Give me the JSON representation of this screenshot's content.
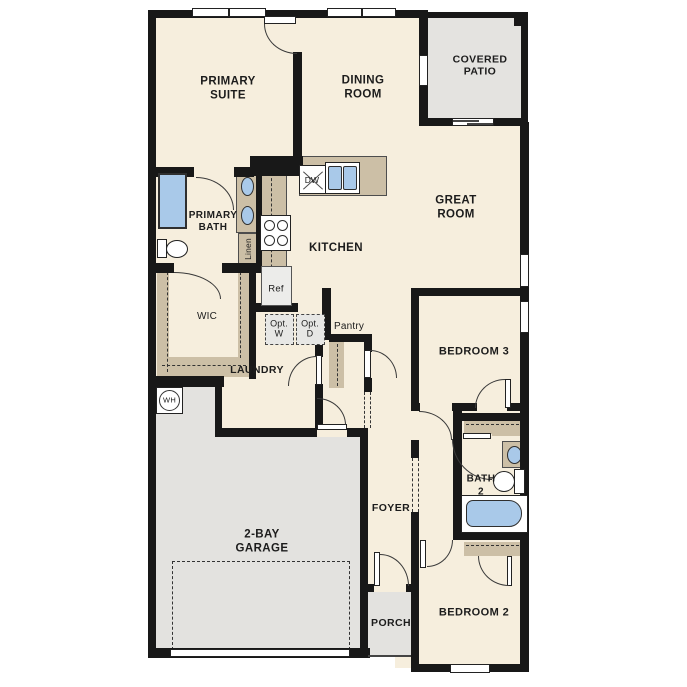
{
  "meta": {
    "type": "residential-floor-plan"
  },
  "rooms": {
    "primary_suite": "PRIMARY\nSUITE",
    "dining_room": "DINING\nROOM",
    "covered_patio": "COVERED\nPATIO",
    "great_room": "GREAT\nROOM",
    "kitchen": "KITCHEN",
    "primary_bath": "PRIMARY\nBATH",
    "wic": "WIC",
    "laundry": "LAUNDRY",
    "pantry": "Pantry",
    "bedroom_3": "BEDROOM 3",
    "bath_2": "BATH\n2",
    "bedroom_2": "BEDROOM 2",
    "foyer": "FOYER",
    "porch": "PORCH",
    "garage": "2-BAY\nGARAGE"
  },
  "fixtures": {
    "linen": "Linen",
    "ref": "Ref",
    "dw": "DW",
    "opt_w": "Opt.\nW",
    "opt_d": "Opt.\nD",
    "wh": "WH"
  },
  "colors": {
    "floor": "#f6eedd",
    "outdoor": "#e3e2df",
    "cabinet": "#ccbfa6",
    "fixture_blue": "#a9c9e9",
    "wall": "#181818"
  }
}
